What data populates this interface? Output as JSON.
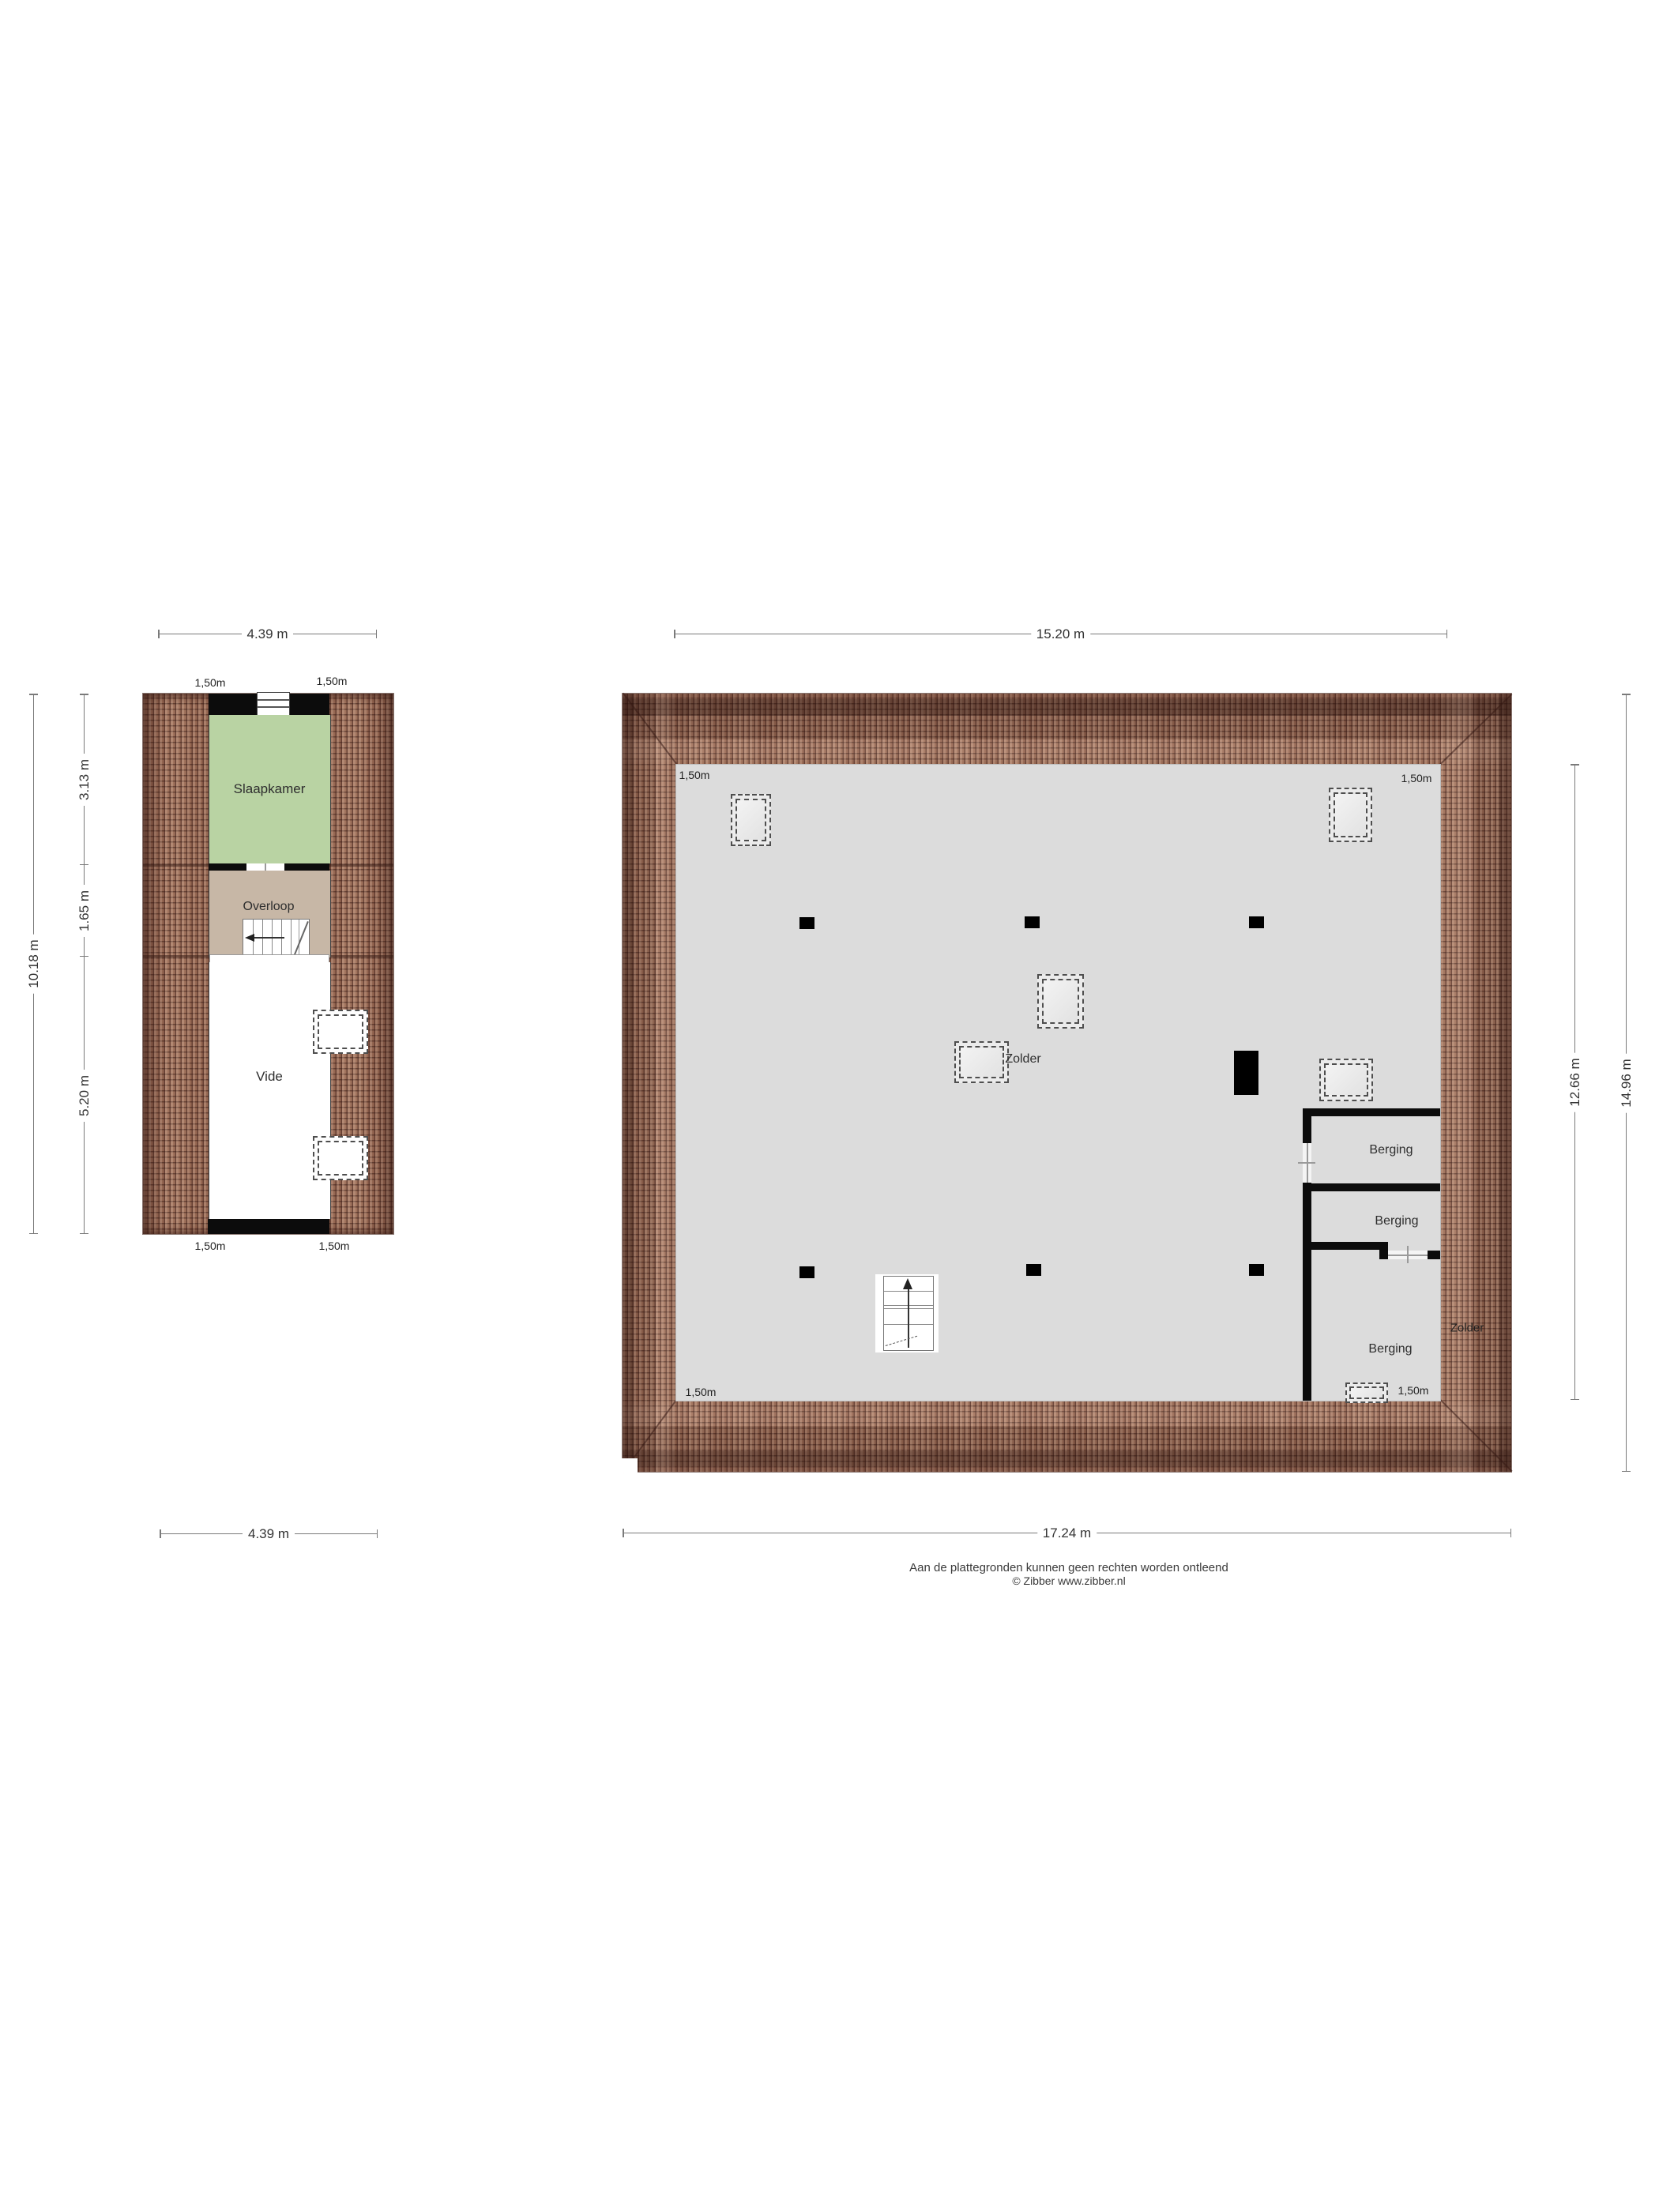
{
  "colors": {
    "roof_tile": "#a0735d",
    "roof_line": "#3e1e18",
    "floor_fill": "#dcdcdc",
    "slaapkamer_fill": "#b9d3a3",
    "overloop_fill": "#c7b7a6",
    "wall": "#0c0c0c",
    "dim_line": "#7a7a7a"
  },
  "left_plan": {
    "rooms": {
      "slaapkamer": "Slaapkamer",
      "overloop": "Overloop",
      "vide": "Vide"
    },
    "dims": {
      "top": "4.39 m",
      "bottom": "4.39 m",
      "outer_left": "10.18 m",
      "seg1": "3.13 m",
      "seg2": "1.65 m",
      "seg3": "5.20 m"
    },
    "edge_labels": {
      "tl": "1,50m",
      "tr": "1,50m",
      "bl": "1,50m",
      "br": "1,50m"
    }
  },
  "right_plan": {
    "rooms": {
      "zolder": "Zolder",
      "zolder_side": "Zolder",
      "berging1": "Berging",
      "berging2": "Berging",
      "berging3": "Berging"
    },
    "dims": {
      "top": "15.20 m",
      "bottom": "17.24 m",
      "inner_right": "12.66 m",
      "outer_right": "14.96 m"
    },
    "corner_labels": {
      "tl": "1,50m",
      "tr": "1,50m",
      "bl": "1,50m",
      "br": "1,50m"
    }
  },
  "footer": {
    "line1": "Aan de plattegronden kunnen geen rechten worden ontleend",
    "line2": "© Zibber www.zibber.nl"
  }
}
